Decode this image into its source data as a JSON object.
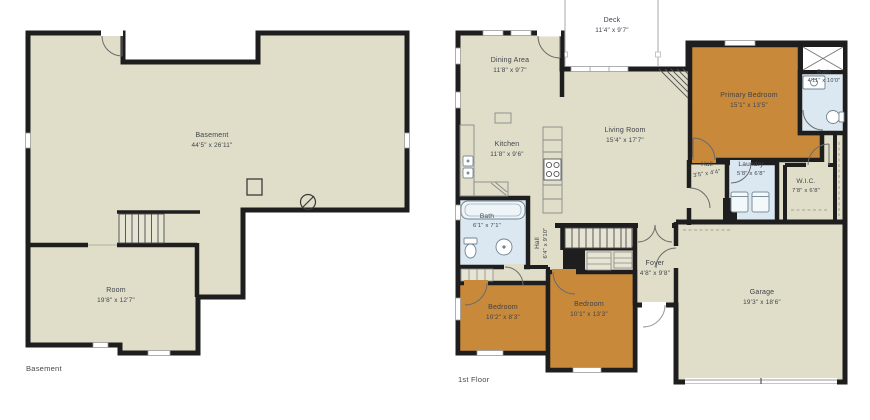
{
  "plans": [
    {
      "title": "Basement",
      "rooms": [
        {
          "name": "Basement",
          "dims": "44'5\" x 26'11\""
        },
        {
          "name": "Room",
          "dims": "19'8\" x 12'7\""
        }
      ]
    },
    {
      "title": "1st Floor",
      "rooms": [
        {
          "name": "Deck",
          "dims": "11'4\" x 9'7\""
        },
        {
          "name": "Dining Area",
          "dims": "11'8\" x 9'7\""
        },
        {
          "name": "Kitchen",
          "dims": "11'8\" x 9'6\""
        },
        {
          "name": "Living Room",
          "dims": "15'4\" x 17'7\""
        },
        {
          "name": "Primary Bedroom",
          "dims": "15'1\" x 13'5\""
        },
        {
          "name": "Bath",
          "dims": "4'11\" x 10'0\""
        },
        {
          "name": "Hall",
          "dims": "3'5\" x 4'4\""
        },
        {
          "name": "Laundry",
          "dims": "5'8\" x 6'8\""
        },
        {
          "name": "W.I.C.",
          "dims": "7'8\" x 6'8\""
        },
        {
          "name": "Bath",
          "dims": "6'1\" x 7'1\""
        },
        {
          "name": "Hall",
          "dims": "6'4\" x 9'10\""
        },
        {
          "name": "Foyer",
          "dims": "4'8\" x 9'8\""
        },
        {
          "name": "Bedroom",
          "dims": "10'2\" x 8'3\""
        },
        {
          "name": "Bedroom",
          "dims": "10'1\" x 13'3\""
        },
        {
          "name": "Garage",
          "dims": "19'3\" x 18'6\""
        }
      ]
    }
  ],
  "colors": {
    "floor": "#e0dec9",
    "wall": "#1e1e1e",
    "bedroom_highlight": "#c8893a",
    "wet_room": "#dbe8f2",
    "label_text": "#3f434b"
  }
}
